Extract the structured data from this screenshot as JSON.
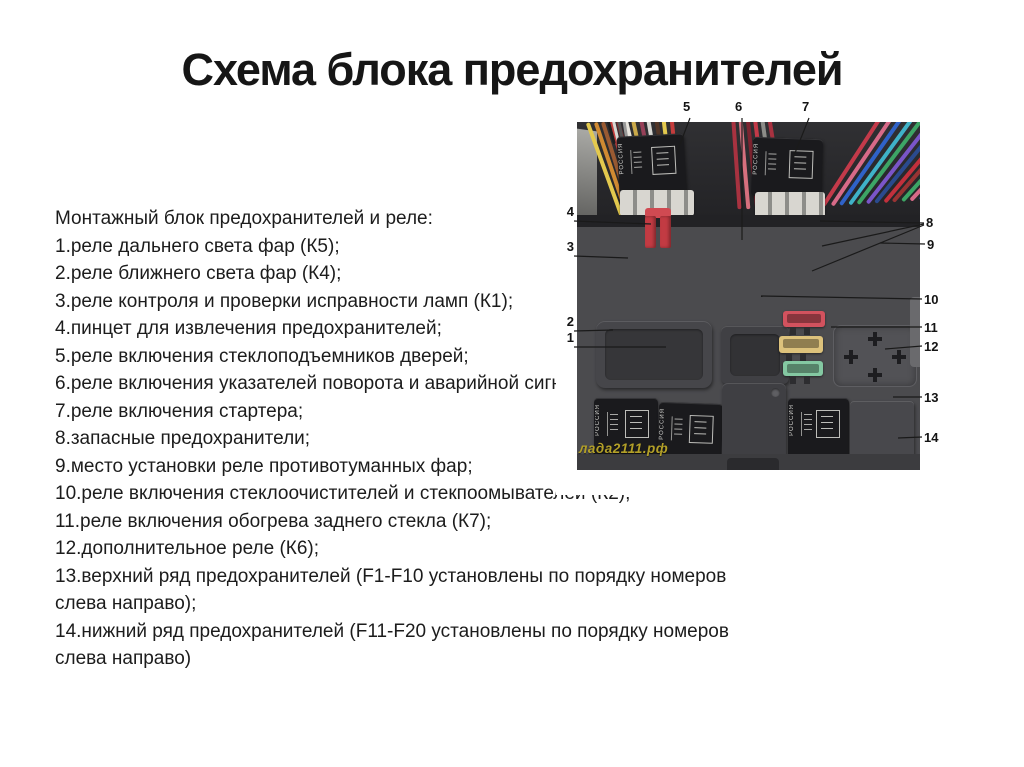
{
  "page": {
    "title": "Схема блока предохранителей"
  },
  "legend": {
    "header": "Монтажный блок предохранителей и реле:",
    "items": [
      "1.реле дальнего света фар (К5);",
      "2.реле ближнего света фар (К4);",
      "3.реле контроля и проверки исправности ламп (К1);",
      "4.пинцет для извлечения предохранителей;",
      "5.реле включения стеклоподъемников дверей;",
      "6.реле включения указателей поворота и аварийной сигнали",
      "7.реле включения стартера;",
      "8.запасные предохранители;",
      "9.место установки реле противотуманных фар;",
      "10.реле включения стеклоочистителей и стекпоомывателей (К2);",
      "11.реле включения обогрева заднего стекла (К7);",
      "12.дополнительное реле (К6);",
      "13.верхний ряд предохранителей (F1-F10 установлены по порядку номеров\nслева направо);",
      "14.нижний ряд предохранителей (F11-F20 установлены по порядку номеров\nслева направо)"
    ]
  },
  "figure": {
    "watermark": "лада2111.рф",
    "relay_marking": "РОССИЯ",
    "callouts": [
      "1",
      "2",
      "3",
      "4",
      "5",
      "6",
      "7",
      "8",
      "9",
      "10",
      "11",
      "12",
      "13",
      "14"
    ],
    "colors": {
      "photo_top_bg": "#29292c",
      "box_body": "#4b4b4e",
      "tweezers_red": "#c23b43",
      "spare_fuses": [
        "#d2525e",
        "#ddc27c",
        "#84c8a2"
      ],
      "fuse_row_top": [
        "#cfc9b4",
        "#3f2f26",
        "#df7a88",
        "#df7a88",
        "#98d0ac",
        "#9ed2c6",
        "#d9bd72",
        "#e4d6a4",
        "#d9bd72",
        "#dcc278"
      ],
      "fuse_row_bottom": [
        "#b4ab96",
        "#42332a",
        "#df7a88",
        "#e08a96",
        "#d8ae52",
        "#dd6e7e",
        "#57382c",
        "#ececec",
        "#df7a88",
        "#342a24"
      ],
      "wires_left": [
        "#e3c94e",
        "#d08a32",
        "#9a5a32",
        "#c43d3d",
        "#7d2a2e",
        "#e8e5de",
        "#caa94a",
        "#974058",
        "#d8d7d2",
        "#513526",
        "#e3c94e",
        "#c43d3d"
      ],
      "wires_center": [
        "#a83240",
        "#d6707e",
        "#7e2430",
        "#c23a48",
        "#8c8c88",
        "#a83240"
      ],
      "wires_right": [
        "#c43a4a",
        "#d76a88",
        "#2f62c8",
        "#3fb2c8",
        "#3da565",
        "#7a55c8",
        "#2a4a8e",
        "#c2303c",
        "#993333",
        "#3da565",
        "#d76a88",
        "#2f62c8"
      ],
      "wires_topleft": [
        "#1e1e20",
        "#d8d8d4",
        "#555555",
        "#999999"
      ]
    }
  }
}
